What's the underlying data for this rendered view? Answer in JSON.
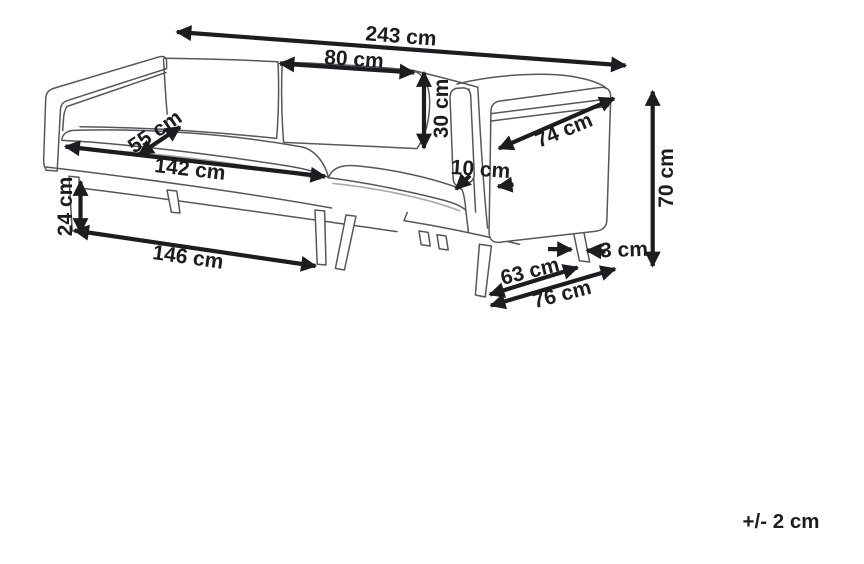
{
  "unit": "cm",
  "colors": {
    "background": "#ffffff",
    "sofa_outline": "#54575c",
    "sofa_shadow_line": "#a7aaad",
    "dimension_ink": "#1d1d1f"
  },
  "dimensions": {
    "overall_width": {
      "label": "243 cm",
      "value": 243
    },
    "back_cushion_width": {
      "label": "80 cm",
      "value": 80
    },
    "back_cushion_height": {
      "label": "30 cm",
      "value": 30
    },
    "seat_depth": {
      "label": "55 cm",
      "value": 55
    },
    "seat_width": {
      "label": "142 cm",
      "value": 142
    },
    "armrest_panel_depth": {
      "label": "74 cm",
      "value": 74
    },
    "armrest_thickness": {
      "label": "10 cm",
      "value": 10
    },
    "overall_height": {
      "label": "70 cm",
      "value": 70
    },
    "leg_height": {
      "label": "24 cm",
      "value": 24
    },
    "base_front_width": {
      "label": "146 cm",
      "value": 146
    },
    "base_side_inner_depth": {
      "label": "63 cm",
      "value": 63
    },
    "leg_thickness": {
      "label": "3 cm",
      "value": 3
    },
    "base_side_depth": {
      "label": "76 cm",
      "value": 76
    }
  },
  "tolerance_note": "+/- 2 cm"
}
